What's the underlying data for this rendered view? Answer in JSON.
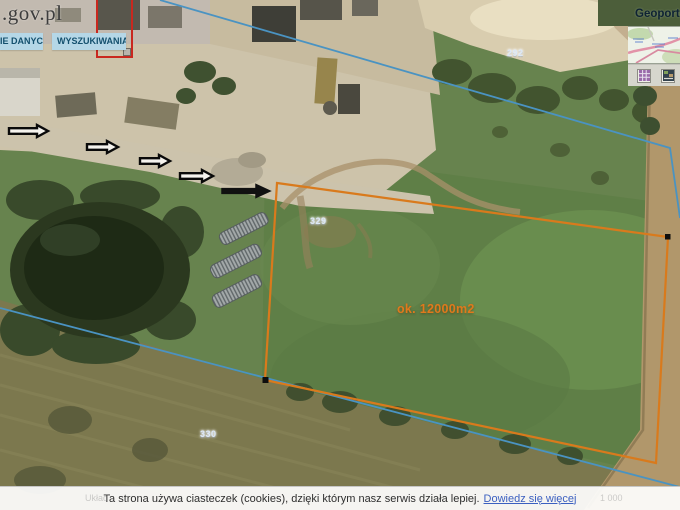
{
  "branding": {
    "logo": ".gov.pl"
  },
  "tabs": [
    {
      "label": "IE DANYCH"
    },
    {
      "label": "WYSZUKIWANIA"
    }
  ],
  "overview_panel": {
    "title": "Geoportal",
    "icons": [
      "legend-icon",
      "minimap-icon"
    ]
  },
  "map_annotations": {
    "parcel_labels": [
      {
        "text": "292"
      },
      {
        "text": "329"
      },
      {
        "text": "330"
      }
    ],
    "area_label": "ok. 12000m2",
    "arrow_count": 5,
    "colors": {
      "parcel_outline": "#d97a1c",
      "boundary_line": "#4a93c2",
      "selection_box": "#c9281f",
      "area_label_color": "#e0791c"
    }
  },
  "cookie_banner": {
    "message": "Ta strona używa ciasteczek (cookies), dzięki którym nasz serwis działa lepiej.",
    "link": "Dowiedz się więcej"
  },
  "footer_faint": {
    "left": "Układ",
    "right": "1 000"
  }
}
